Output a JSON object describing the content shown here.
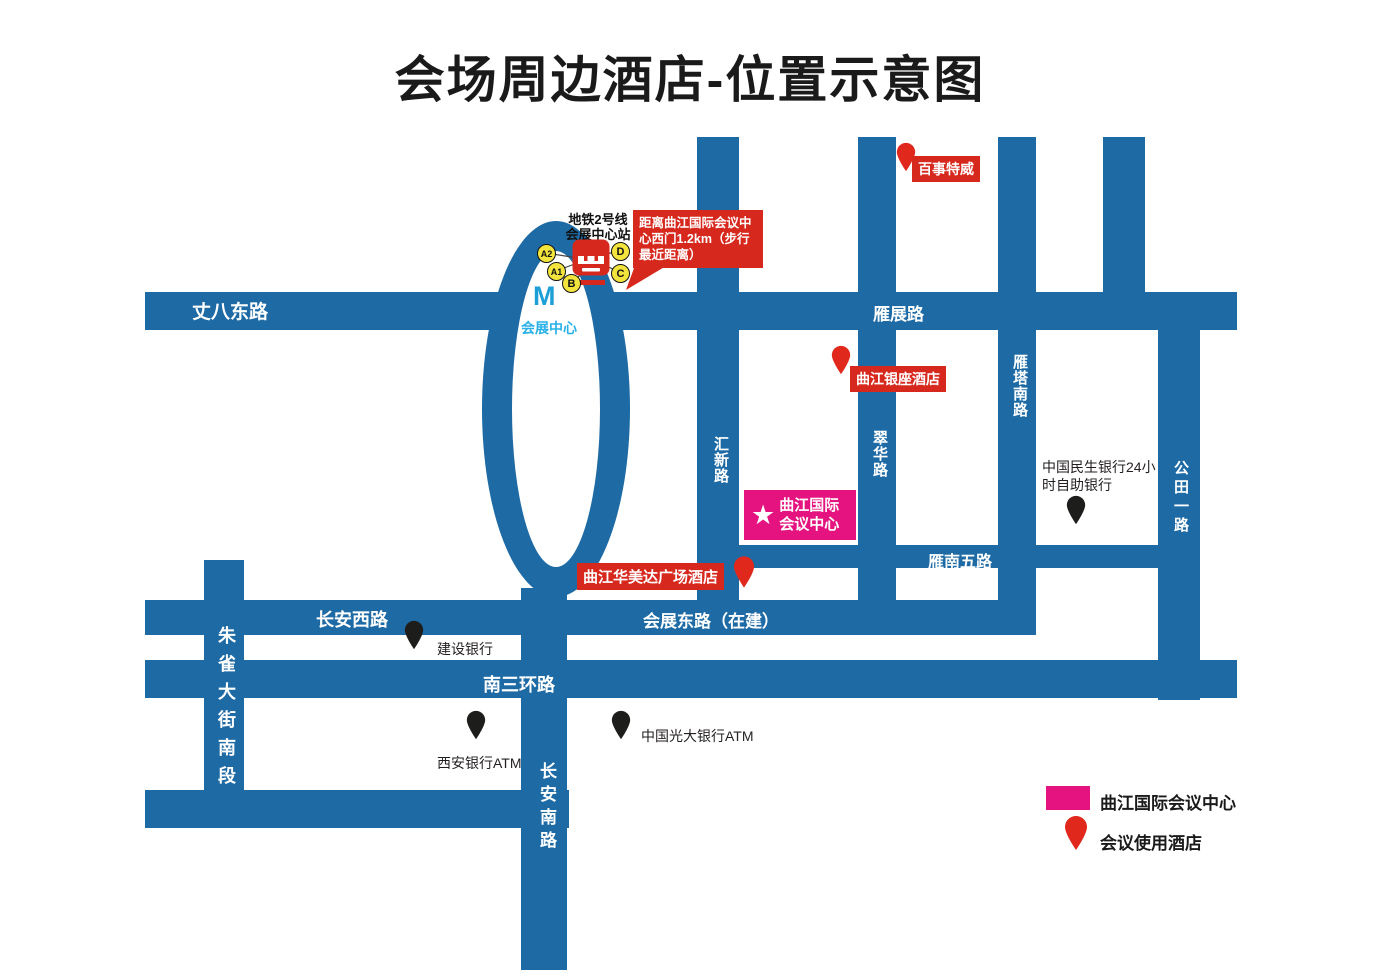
{
  "title": "会场周边酒店-位置示意图",
  "colors": {
    "road_blue": "#1d6aa5",
    "label_red": "#d7281e",
    "venue_magenta": "#e5137f",
    "metro_cyan": "#29b1e6",
    "exit_yellow": "#f2e43c"
  },
  "roads": {
    "zhangba_east_road": "丈八东路",
    "yanzhan_road": "雁展路",
    "huixin_road": "汇新路",
    "cuihua_road": "翠华路",
    "yanta_south_road": "雁塔南路",
    "gongtian_1st_road": "公田一路",
    "yannan_5th_road": "雁南五路",
    "changan_west_road": "长安西路",
    "huizhan_east_road": "会展东路（在建）",
    "south_3rd_ring_road": "南三环路",
    "zhuque_street_south": "朱雀大街南段",
    "changan_south_road": "长安南路"
  },
  "metro": {
    "station_line1": "地铁2号线",
    "station_line2": "会展中心站",
    "exits": {
      "a2": "A2",
      "a1": "A1",
      "b": "B",
      "c": "C",
      "d": "D"
    },
    "logo_letter": "M",
    "expo_center": "会展中心",
    "distance_callout": "距离曲江国际会议中心西门1.2km（步行最近距离）"
  },
  "venue": {
    "star": "★",
    "line1": "曲江国际",
    "line2": "会议中心"
  },
  "hotels": {
    "best_west": "百事特威",
    "yinzuo": "曲江银座酒店",
    "ramada": "曲江华美达广场酒店"
  },
  "banks": {
    "ccb": "建设银行",
    "xian_atm": "西安银行ATM",
    "ceb_atm": "中国光大银行ATM",
    "minsheng": "中国民生银行24小时自助银行"
  },
  "legend": {
    "venue_label": "曲江国际会议中心",
    "hotel_label": "会议使用酒店"
  }
}
